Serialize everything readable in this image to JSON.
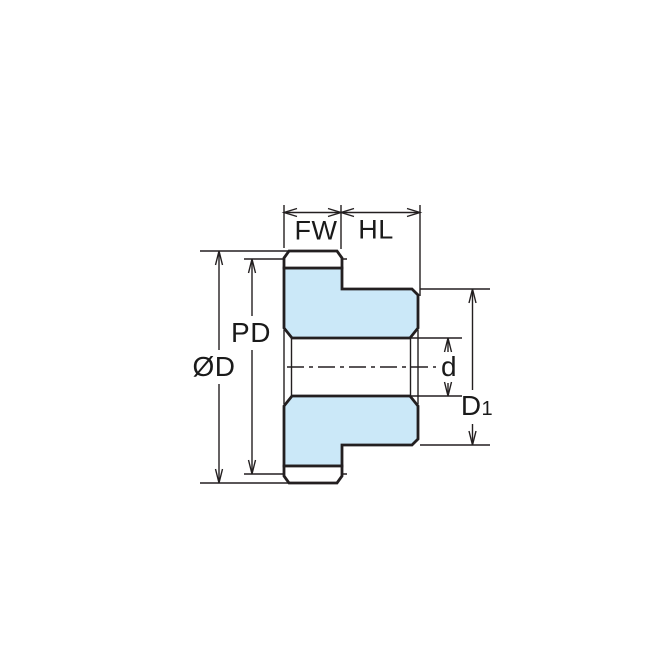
{
  "labels": {
    "face_width": "FW",
    "hub_length": "HL",
    "pitch_diameter": "PD",
    "outside_diameter": "ØD",
    "bore_diameter": "d",
    "hub_diameter_main": "D",
    "hub_diameter_sub": "1"
  },
  "colors": {
    "gear_fill": "#cbe8f8",
    "line": "#231f20",
    "background": "#ffffff"
  }
}
